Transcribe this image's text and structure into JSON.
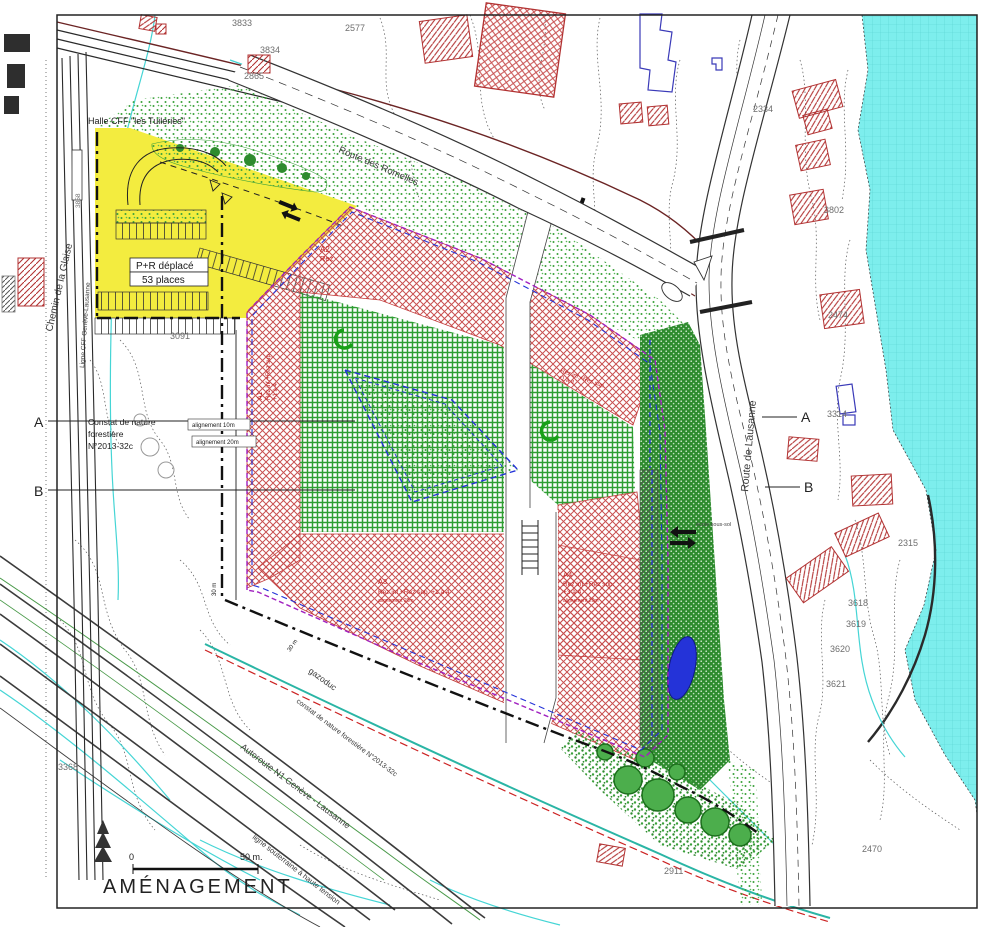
{
  "title": "AMÉNAGEMENT",
  "scale_bar": {
    "start": "0",
    "end": "50 m."
  },
  "sections": {
    "a": "A",
    "b": "B"
  },
  "roads": {
    "chemin_glaise": "Chemin de la Glaise",
    "ligne_cff": "Ligne CFF Genève-Lausanne",
    "route_romelles": "Route des Romelles",
    "route_lausanne": "Route de Lausanne",
    "autoroute": "Autoroute N1 Genève - Lausanne",
    "gazoduc": "gazoduc",
    "haute_tension": "ligne souterraine à haute tension",
    "constat_forestier": "constat de nature forestière N°2013-32c"
  },
  "annotations": {
    "halle": "Halle CFF \"les Tuileries\"",
    "pr1": "P+R déplacé",
    "pr2": "53 places",
    "constat1": "Constat de nature",
    "constat2": "forestière",
    "constat3": "N°2013-32c",
    "align10": "alignement 10m",
    "align20": "alignement 20m",
    "d30": "30 m",
    "ecole": "école sous-sol"
  },
  "zones": {
    "a1": {
      "id": "A1",
      "l1": "Rez inf.+Rez sup.",
      "l2": "+1 à 4"
    },
    "a2": {
      "id": "A2",
      "l1": "Rez"
    },
    "band": {
      "l1": "Rez inf.+Rez sup.",
      "l2": "+1 à 4"
    },
    "a3": {
      "id": "A3",
      "l1": "Rez inf.+Rez sup. +1 à 4",
      "l2": "alignement 20m"
    },
    "a4": {
      "id": "A4",
      "l1": "Rez inf.+Rez sup.",
      "l2": "+3 à 4",
      "l3": "alignement 20m"
    }
  },
  "parcels": {
    "p3833": "3833",
    "p3834": "3834",
    "p2865": "2865",
    "p2577": "2577",
    "p3858": "3858",
    "p3091": "3091",
    "p3368": "3368",
    "p2334": "2334",
    "p3802": "3802",
    "p2474": "2474",
    "p3314": "3314",
    "p2315": "2315",
    "p3618": "3618",
    "p3619": "3619",
    "p3620": "3620",
    "p3621": "3621",
    "p2911": "2911",
    "p2470": "2470"
  },
  "colors": {
    "yellow": "#f3ec3f",
    "red": "#c23b3b",
    "green": "#2f9e33",
    "dark_green": "#2e8b2e",
    "lake": "#7deeed",
    "blue": "#2433d8",
    "purple": "#a020c0",
    "cyan": "#45d5d5"
  }
}
